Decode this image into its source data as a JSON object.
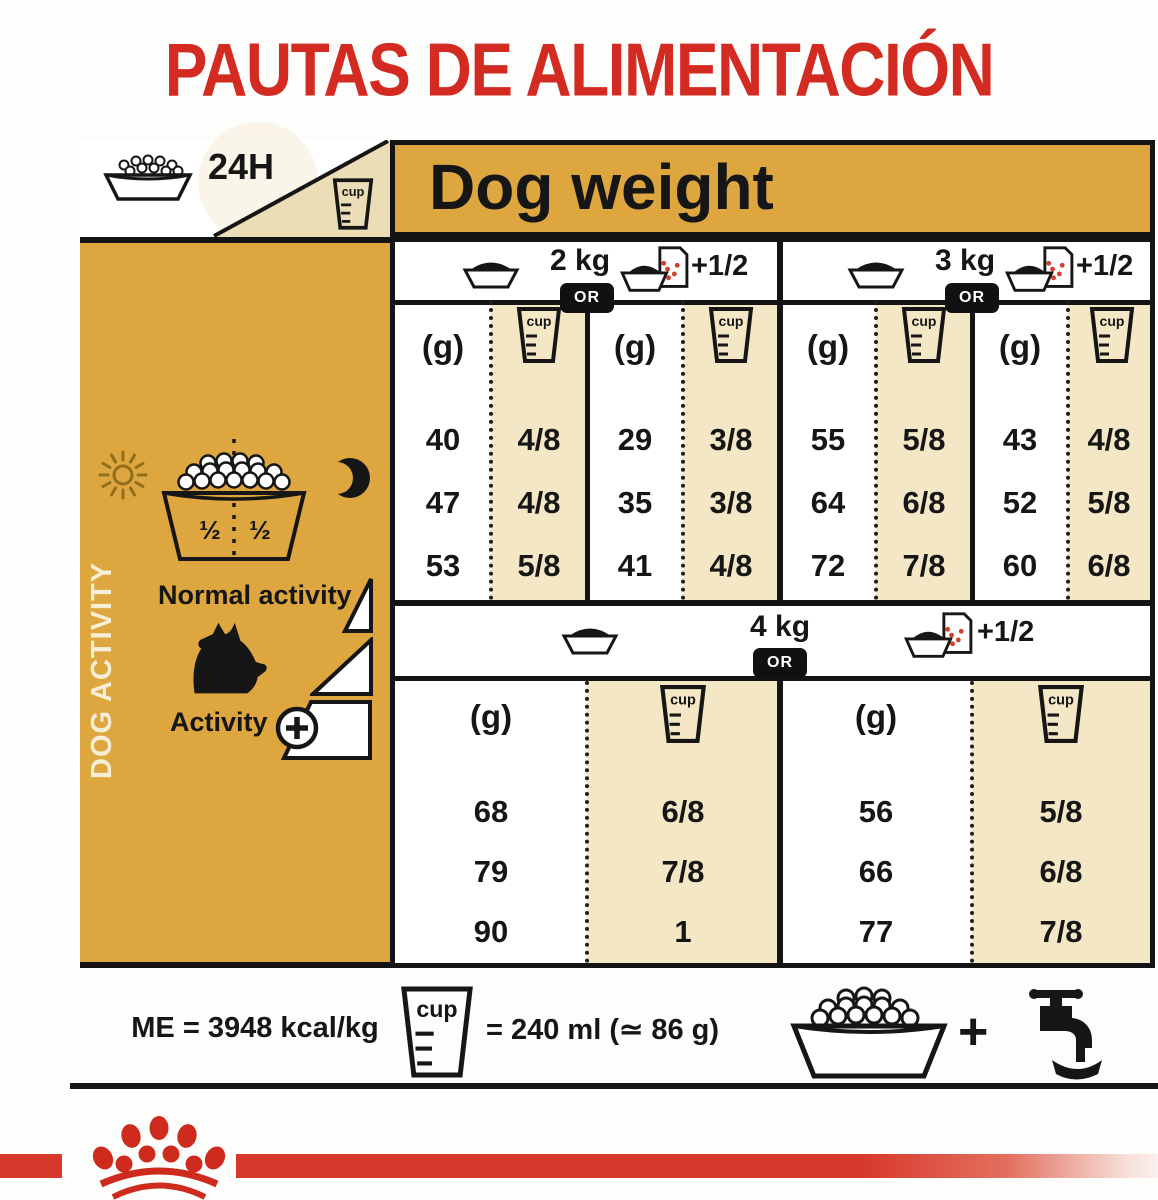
{
  "title": "PAUTAS DE ALIMENTACIÓN",
  "top_left": {
    "hours": "24H"
  },
  "dog_weight_label": "Dog weight",
  "units": {
    "g": "(g)",
    "cup": "cup",
    "or": "OR",
    "plus_half": "+1/2"
  },
  "groups": [
    {
      "weight": "2 kg",
      "plain": {
        "rows": [
          [
            "40",
            "4/8"
          ],
          [
            "47",
            "4/8"
          ],
          [
            "53",
            "5/8"
          ]
        ]
      },
      "pouch": {
        "rows": [
          [
            "29",
            "3/8"
          ],
          [
            "35",
            "3/8"
          ],
          [
            "41",
            "4/8"
          ]
        ]
      }
    },
    {
      "weight": "3 kg",
      "plain": {
        "rows": [
          [
            "55",
            "5/8"
          ],
          [
            "64",
            "6/8"
          ],
          [
            "72",
            "7/8"
          ]
        ]
      },
      "pouch": {
        "rows": [
          [
            "43",
            "4/8"
          ],
          [
            "52",
            "5/8"
          ],
          [
            "60",
            "6/8"
          ]
        ]
      }
    },
    {
      "weight": "4 kg",
      "plain": {
        "rows": [
          [
            "68",
            "6/8"
          ],
          [
            "79",
            "7/8"
          ],
          [
            "90",
            "1"
          ]
        ]
      },
      "pouch": {
        "rows": [
          [
            "56",
            "5/8"
          ],
          [
            "66",
            "6/8"
          ],
          [
            "77",
            "7/8"
          ]
        ]
      }
    }
  ],
  "sidebar": {
    "vertical_label": "DOG ACTIVITY",
    "half_left": "½",
    "half_right": "½",
    "normal_activity": "Normal activity",
    "activity": "Activity"
  },
  "footer": {
    "me": "ME = 3948 kcal/kg",
    "cup_equiv": "= 240 ml (≃ 86 g)",
    "plus": "+"
  },
  "colors": {
    "gold": "#DDA63F",
    "beige": "#F4E7C6",
    "red_title": "#D32A22",
    "band_red": "#D7382B",
    "crown_red": "#CE2B1E"
  }
}
